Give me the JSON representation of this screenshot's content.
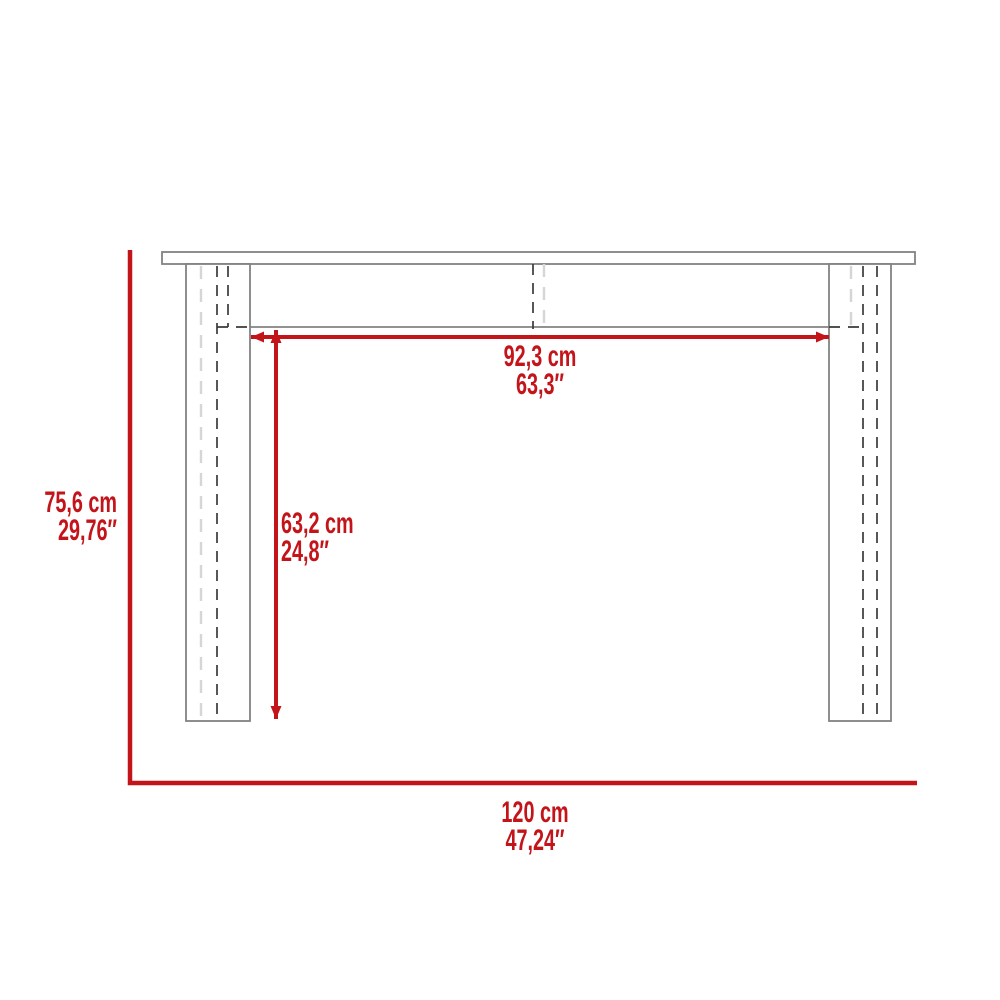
{
  "diagram": {
    "type": "furniture-dimension-drawing",
    "view": "console-table-front-elevation"
  },
  "labels": {
    "overall_height": {
      "cm": "75,6 cm",
      "in": "29,76″"
    },
    "inner_width": {
      "cm": "92,3 cm",
      "in": "63,3″"
    },
    "inner_height": {
      "cm": "63,2 cm",
      "in": "24,8″"
    },
    "overall_width": {
      "cm": "120 cm",
      "in": "47,24″"
    }
  },
  "colors": {
    "dimension_red": "#c3141a",
    "outline_gray": "#828282",
    "hidden_dark": "#3a3a3a",
    "hidden_light": "#d6d6d6",
    "background": "#ffffff"
  }
}
